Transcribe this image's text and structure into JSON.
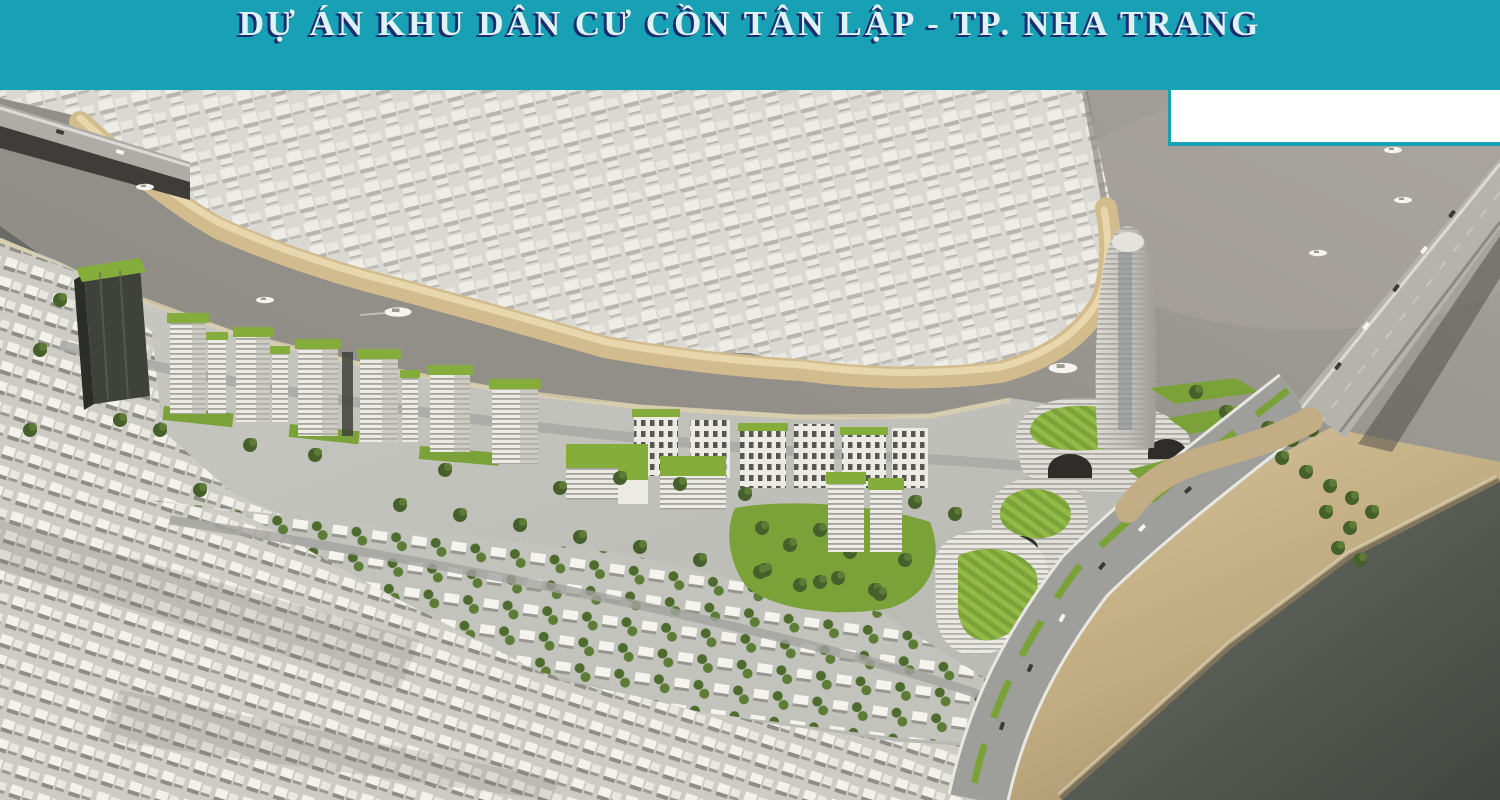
{
  "banner": {
    "title": "DỰ ÁN KHU DÂN CƯ CỒN TÂN LẬP - TP. NHA TRANG"
  },
  "scene": {
    "alt": "Aerial 3D rendering of the Con Tan Lap residential project on a river island in Nha Trang city: green-roofed towers and curved landmark buildings along the river, villa rows, surrounding white city model, two bridges, coastal road, beach and sea"
  },
  "palette": {
    "banner_bg": "#18a0b4",
    "title_fill": "#ddf3f6",
    "title_shadow": "#1d2c6e",
    "patch_bg": "#ffffff",
    "water_a": "#8f8c86",
    "water_b": "#a6a39c",
    "land_a": "#c9c9c3",
    "land_b": "#b5b5af",
    "far_city": "#d9d8d2",
    "far_block": "#efeee8",
    "far_shadow": "#b3b1a9",
    "old_bg": "#cccbc4",
    "old_block": "#f2f1eb",
    "old_shadow": "#8f8d85",
    "sand": "#d2bc8e",
    "sand_light": "#ead9b0",
    "beach_a": "#d6c49c",
    "beach_b": "#a6916b",
    "beach_wet": "#6e6754",
    "sea_a": "#6a6e66",
    "sea_b": "#414740",
    "road": "#9e9e9a",
    "road_edge": "#e8e7e2",
    "bridge_deck": "#b5b3ad",
    "bridge_shadow": "#53524c",
    "roof_green": "#85ad3c",
    "lawn_green": "#7aa238",
    "terrace_a": "#7ca33a",
    "terrace_b": "#93ba48",
    "tree_dark": "#46602c",
    "tree_mid": "#5f7e35",
    "bldg_white": "#eceae5",
    "bldg_stripe": "#a8a69e",
    "bldg_shade": "#b7b5ae",
    "window_dark": "#3c3c38",
    "tower_dark": "#3f423b",
    "tower_dark_side": "#2b2e28",
    "boat_white": "#f4f3ef"
  }
}
